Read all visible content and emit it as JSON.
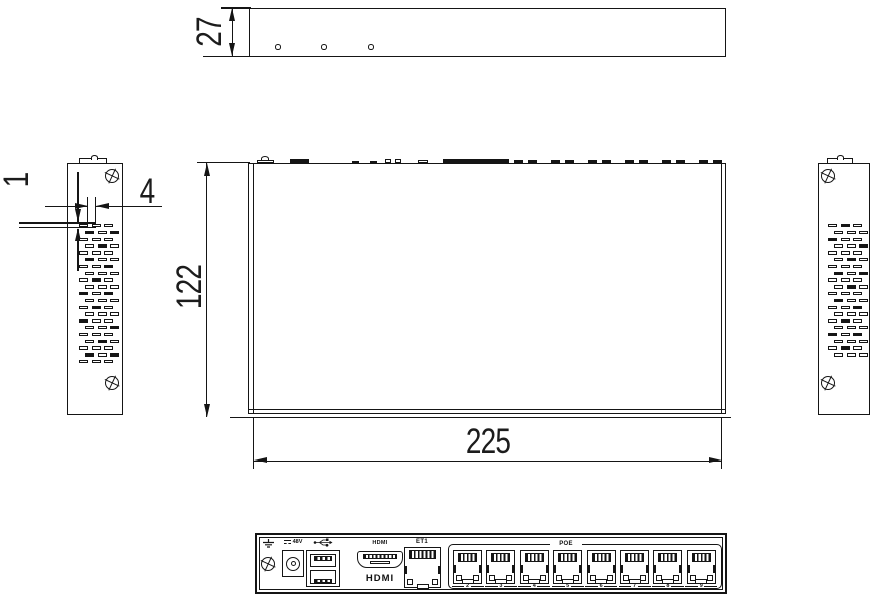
{
  "dimensions": {
    "front_height_mm": "27",
    "vent_slot_pitch_mm": "1",
    "vent_slot_width_mm": "4",
    "body_depth_mm": "122",
    "body_width_mm": "225"
  },
  "rear_panel": {
    "power_label": "48V",
    "hdmi_port_label": "HDMI",
    "hdmi_logo_text": "HDMI",
    "single_port_label": "ET1",
    "port_group_label": "POE",
    "port_numbers": [
      "2",
      "3",
      "4",
      "5",
      "6",
      "7",
      "8",
      "9"
    ],
    "icons": [
      "earth-ground-icon",
      "usb-icon",
      "dc-polarity-icon"
    ]
  }
}
